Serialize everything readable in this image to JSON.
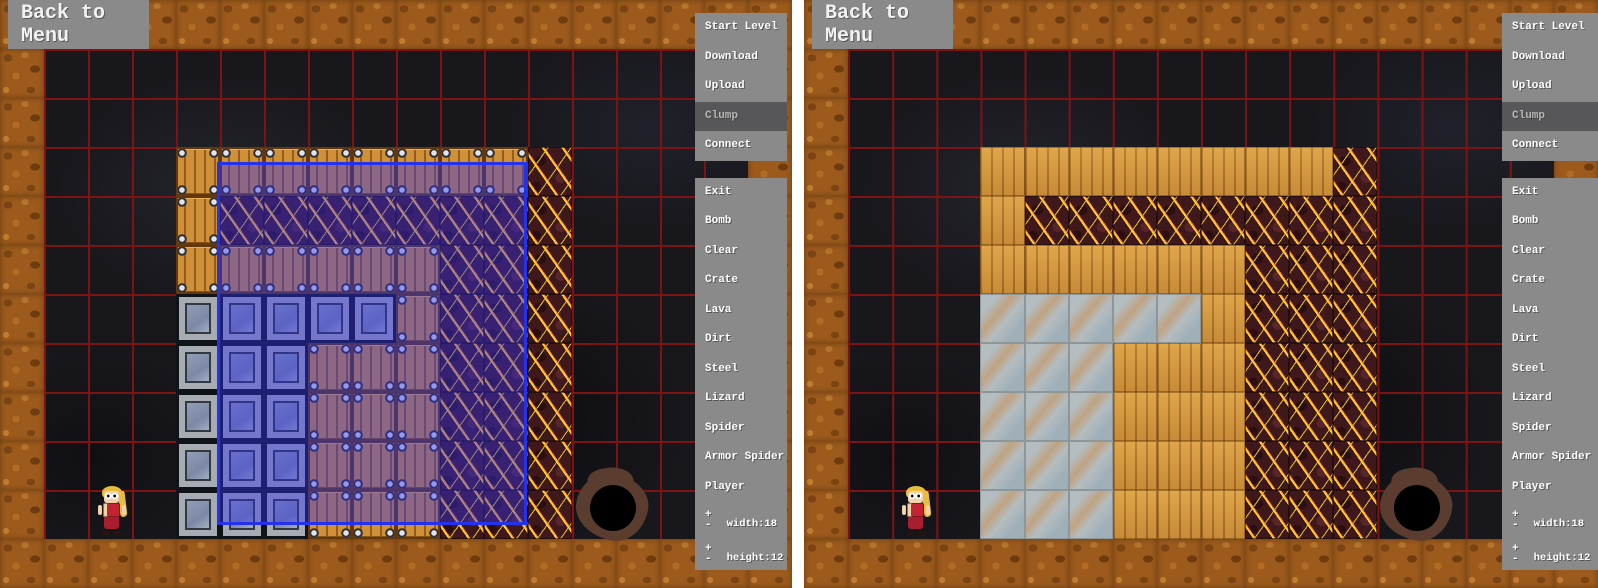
{
  "back_to_menu": "Back to Menu",
  "sidebar": {
    "menu_items": [
      "Start Level",
      "Download",
      "Upload",
      "Clump",
      "Connect"
    ],
    "selected_item": "Clump",
    "tool_items": [
      "Exit",
      "Bomb",
      "Clear",
      "Crate",
      "Lava",
      "Dirt",
      "Steel",
      "Lizard",
      "Spider",
      "Armor Spider",
      "Player"
    ],
    "plus_glyph": "+",
    "minus_glyph": "-",
    "steppers": [
      {
        "name": "width",
        "label": "width:18",
        "value": 18
      },
      {
        "name": "height",
        "label": "height:12",
        "value": 12
      }
    ]
  },
  "level": {
    "width": 18,
    "height": 12
  },
  "tiles": {
    "legend": {
      "D": "dirt",
      ".": "empty",
      "C": "crate",
      "S": "steel",
      "L": "lava",
      "W": "wood",
      "G": "glass"
    }
  },
  "panels": [
    {
      "id": "left",
      "tile_map": [
        "DDDDDDDDDDDDDDDDDD",
        "D................D",
        "D................D",
        "D...CCCCCCCCL....D",
        "D...CLLLLLLLL....D",
        "D...CCCCCCLLL....D",
        "D...SSSSSCLLL....D",
        "D...SSSCCCLLL....D",
        "D...SSSCCCLLL....D",
        "D...SSSCCCLLL....D",
        "D...SSSCCCLLL....D",
        "DDDDDDDDDDDDDDDDDD"
      ],
      "selection": {
        "left": 217,
        "top": 162,
        "width": 310,
        "height": 363
      },
      "player": {
        "x": 97,
        "y": 486
      },
      "hole": {
        "x": 576,
        "y": 474
      }
    },
    {
      "id": "right",
      "tile_map": [
        "DDDDDDDDDDDDDDDDDD",
        "D................D",
        "D................D",
        "D...WWWWWWWWL....D",
        "D...WLLLLLLLL....D",
        "D...WWWWWWLLL....D",
        "D...GGGGGWLLL....D",
        "D...GGGWWWLLL....D",
        "D...GGGWWWLLL....D",
        "D...GGGWWWLLL....D",
        "D...GGGWWWLLL....D",
        "DDDDDDDDDDDDDDDDDD"
      ],
      "selection": null,
      "player": {
        "x": 97,
        "y": 486
      },
      "hole": {
        "x": 576,
        "y": 474
      }
    }
  ],
  "colors": {
    "sidebar_gray": "#8a8a8a",
    "sidebar_selected": "#57575a",
    "grid_red": "#7e1313",
    "selection_blue": "#2531ea",
    "dirt_brown": "#9c5b1d",
    "cave_dark": "#17171c"
  }
}
